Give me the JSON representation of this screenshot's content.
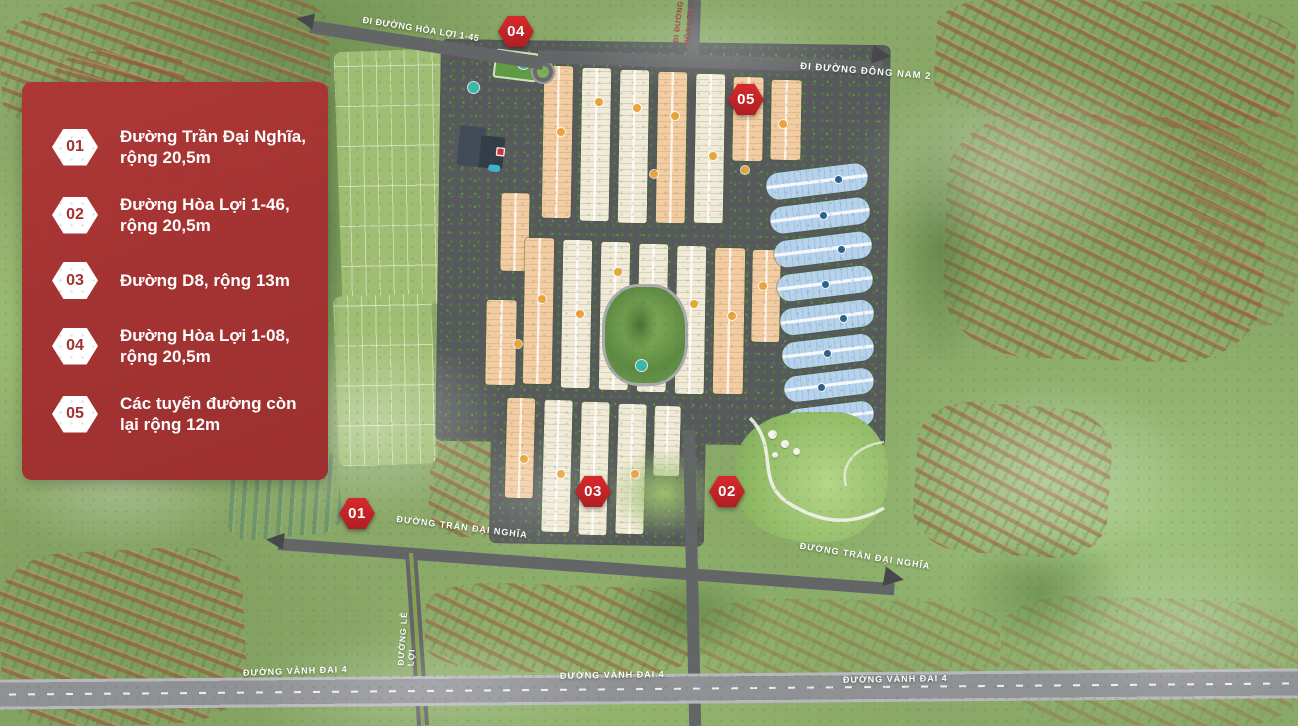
{
  "map": {
    "title": "Masterplan khu dân cư - sơ đồ các tuyến đường",
    "legend": {
      "items": [
        {
          "num": "01",
          "label": "Đường Trần Đại Nghĩa,\nrộng 20,5m"
        },
        {
          "num": "02",
          "label": "Đường Hòa Lợi 1-46,\nrộng 20,5m"
        },
        {
          "num": "03",
          "label": "Đường D8, rộng 13m"
        },
        {
          "num": "04",
          "label": "Đường Hòa Lợi 1-08,\nrộng 20,5m"
        },
        {
          "num": "05",
          "label": "Các tuyến đường còn\nlại rộng 12m"
        }
      ]
    },
    "markers": [
      {
        "label": "01"
      },
      {
        "label": "02"
      },
      {
        "label": "03"
      },
      {
        "label": "04"
      },
      {
        "label": "05"
      }
    ],
    "road_labels": [
      {
        "text": "ĐI ĐƯỜNG HÒA LỢI 1-45"
      },
      {
        "text": "ĐI ĐƯỜNG\nHÒA LỢI 1-"
      },
      {
        "text": "ĐI ĐƯỜNG ĐÔNG NAM 2"
      },
      {
        "text": "ĐƯỜNG TRẦN ĐẠI NGHĨA"
      },
      {
        "text": "ĐƯỜNG TRẦN ĐẠI NGHĨA"
      },
      {
        "text": "ĐƯỜNG LÊ LỢI"
      },
      {
        "text": "ĐƯỜNG VÀNH ĐAI 4"
      },
      {
        "text": "ĐƯỜNG VÀNH ĐAI 4"
      },
      {
        "text": "ĐƯỜNG VÀNH ĐAI 4"
      }
    ],
    "colors": {
      "legend_panel": "#a43232",
      "marker_red": "#c42127",
      "road_label_text": "#ffffff",
      "side_label_red": "#a23a33",
      "lot_peach": "#f2cda3",
      "lot_cream": "#f0ead8",
      "lot_blue": "#b7d3ec",
      "road_gray": "#58595c",
      "highway_gray": "#909195"
    }
  }
}
